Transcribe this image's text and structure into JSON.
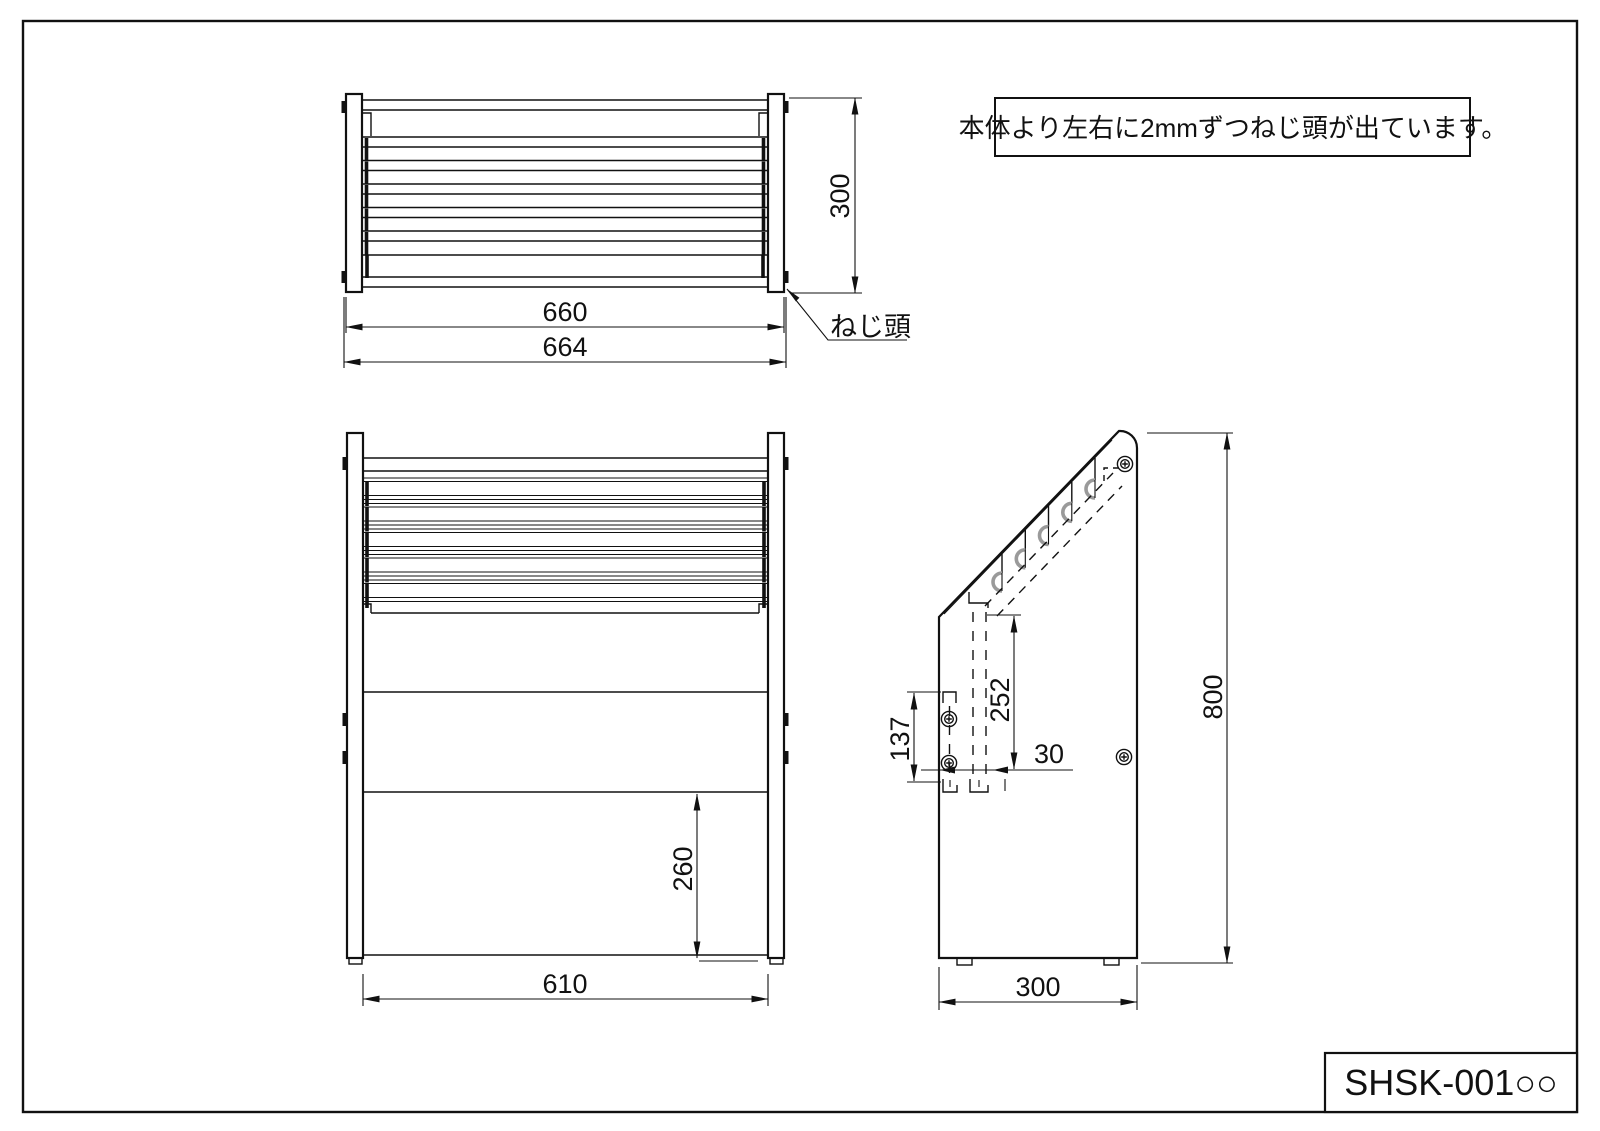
{
  "note": {
    "text": "本体より左右に2mmずつねじ頭が出ています。"
  },
  "title_block": {
    "part_number": "SHSK-001○○"
  },
  "callouts": {
    "screw_head": "ねじ頭"
  },
  "dims": {
    "top_width_body": "660",
    "top_width_overall": "664",
    "top_depth": "300",
    "front_width": "610",
    "front_lower_height": "260",
    "side_height": "800",
    "side_depth": "300",
    "side_slot_length": "252",
    "side_screw_pitch": "137",
    "side_slot_offset": "30"
  },
  "colors": {
    "line": "#111111",
    "hook_gray": "#9a9a9a",
    "background": "#ffffff"
  }
}
